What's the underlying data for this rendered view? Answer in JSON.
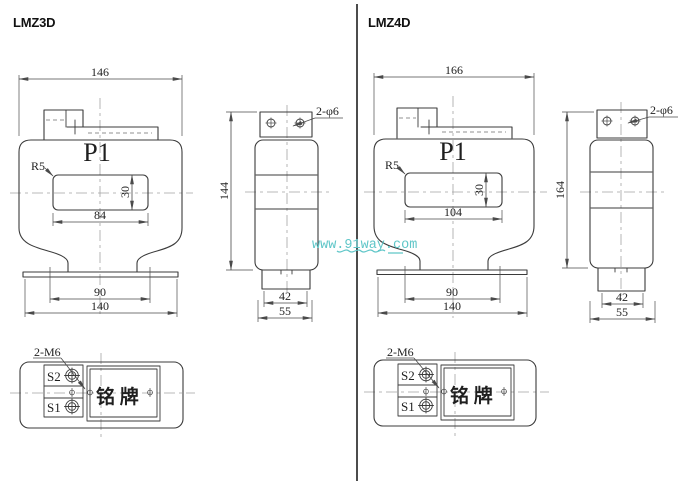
{
  "watermark": {
    "text": "www.91way.com",
    "color": "#5fc6c8"
  },
  "left": {
    "title": "LMZ3D",
    "front_view": {
      "top_width": "146",
      "terminal_label": "P1",
      "corner_radius_label": "R5",
      "window_width": "84",
      "window_height": "30",
      "mounting_span": "90",
      "base_width": "140"
    },
    "side_view": {
      "holes_label": "2-φ6",
      "height": "144",
      "foot_width": "42",
      "base_depth": "55"
    },
    "bottom_view": {
      "screws_label": "2-M6",
      "terminal_s2": "S2",
      "terminal_s1": "S1",
      "nameplate_label": "铭 牌"
    }
  },
  "right": {
    "title": "LMZ4D",
    "front_view": {
      "top_width": "166",
      "terminal_label": "P1",
      "corner_radius_label": "R5",
      "window_width": "104",
      "window_height": "30",
      "mounting_span": "90",
      "base_width": "140"
    },
    "side_view": {
      "holes_label": "2-φ6",
      "height": "164",
      "foot_width": "42",
      "base_depth": "55"
    },
    "bottom_view": {
      "screws_label": "2-M6",
      "terminal_s2": "S2",
      "terminal_s1": "S1",
      "nameplate_label": "铭 牌"
    }
  }
}
